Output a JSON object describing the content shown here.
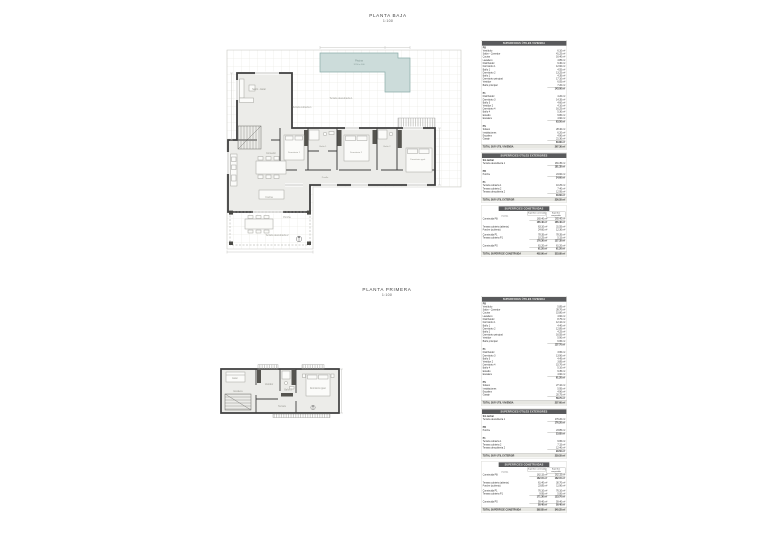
{
  "floors": [
    {
      "title": "PLANTA BAJA",
      "scale": "1:100",
      "labels": {
        "pool": "Piscina",
        "pool_dim": "12.50 x 4.00",
        "terraza1": "Terraza descubierta 1",
        "terraza_cub": "Terraza cubierta 1",
        "salon": "Salón - Estar",
        "comedor": "Comedor",
        "cocina": "Cocina",
        "dorm1": "Dormitorio 1",
        "bano1": "Baño 1",
        "dorm2": "Dormitorio 2",
        "bano2": "Baño 2",
        "dormp": "Dormitorio ppal.",
        "pasillo": "Pasillo",
        "porche": "Porche",
        "terraza2": "Terraza descubierta 2"
      }
    },
    {
      "title": "PLANTA PRIMERA",
      "scale": "1:100",
      "labels": {
        "estar": "Estar",
        "escalera": "Escalera",
        "vestidor": "Vestidor",
        "bano3": "Baño 3",
        "dormp": "Dormitorio ppal.",
        "terraza": "Terraza"
      }
    }
  ],
  "table_groups": [
    {
      "tables": [
        {
          "header": "SUPERFICIES ÚTILES VIVIENDA",
          "rows": [
            {
              "t": "sec",
              "l": "PB"
            },
            {
              "t": "item",
              "l": "Vestíbulo",
              "v": "6.10 m²"
            },
            {
              "t": "item",
              "l": "Salón - Comedor",
              "v": "41.25 m²"
            },
            {
              "t": "item",
              "l": "Cocina",
              "v": "16.40 m²"
            },
            {
              "t": "item",
              "l": "Lavadero",
              "v": "4.85 m²"
            },
            {
              "t": "item",
              "l": "Distribuidor",
              "v": "9.30 m²"
            },
            {
              "t": "item",
              "l": "Dormitorio 1",
              "v": "12.60 m²"
            },
            {
              "t": "item",
              "l": "Baño 1",
              "v": "4.55 m²"
            },
            {
              "t": "item",
              "l": "Dormitorio 2",
              "v": "13.25 m²"
            },
            {
              "t": "item",
              "l": "Baño 2",
              "v": "4.35 m²"
            },
            {
              "t": "item",
              "l": "Dormitorio principal",
              "v": "17.10 m²"
            },
            {
              "t": "item",
              "l": "Vestidor",
              "v": "6.05 m²"
            },
            {
              "t": "item",
              "l": "Baño principal",
              "v": "7.20 m²"
            },
            {
              "t": "sub",
              "v": "143.00 m²"
            },
            {
              "t": "gap"
            },
            {
              "t": "sec",
              "l": "P1"
            },
            {
              "t": "item",
              "l": "Distribuidor",
              "v": "4.20 m²"
            },
            {
              "t": "item",
              "l": "Dormitorio 3",
              "v": "14.35 m²"
            },
            {
              "t": "item",
              "l": "Baño 3",
              "v": "4.60 m²"
            },
            {
              "t": "item",
              "l": "Vestidor 2",
              "v": "4.10 m²"
            },
            {
              "t": "item",
              "l": "Dormitorio 4",
              "v": "16.25 m²"
            },
            {
              "t": "item",
              "l": "Baño 4",
              "v": "5.30 m²"
            },
            {
              "t": "item",
              "l": "Estudio",
              "v": "9.80 m²"
            },
            {
              "t": "item",
              "l": "Escalera",
              "v": "4.90 m²"
            },
            {
              "t": "sub",
              "v": "63.50 m²"
            },
            {
              "t": "gap"
            },
            {
              "t": "sec",
              "l": "PS"
            },
            {
              "t": "item",
              "l": "Sótano",
              "v": "28.40 m²"
            },
            {
              "t": "item",
              "l": "Instalaciones",
              "v": "6.20 m²"
            },
            {
              "t": "item",
              "l": "Escalera",
              "v": "4.90 m²"
            },
            {
              "t": "item",
              "l": "Garaje",
              "v": "21.30 m²"
            },
            {
              "t": "sub",
              "v": "60.80 m²"
            },
            {
              "t": "tot",
              "l": "TOTAL SUP. ÚTIL VIVIENDA",
              "v": "267.30 m²"
            }
          ]
        },
        {
          "header": "SUPERFICIES ÚTILES EXTERIORES",
          "rows": [
            {
              "t": "sec",
              "l": "Sin techar"
            },
            {
              "t": "item",
              "l": "Terraza descubierta 1",
              "v": "181.35 m²"
            },
            {
              "t": "sub",
              "v": "181.35 m²"
            },
            {
              "t": "gap"
            },
            {
              "t": "sec",
              "l": "PB"
            },
            {
              "t": "item",
              "l": "Porche",
              "v": "24.60 m²"
            },
            {
              "t": "sub",
              "v": "24.60 m²"
            },
            {
              "t": "gap"
            },
            {
              "t": "sec",
              "l": "P1"
            },
            {
              "t": "item",
              "l": "Terraza cubierta 1",
              "v": "10.25 m²"
            },
            {
              "t": "item",
              "l": "Terraza cubierta 2",
              "v": "7.40 m²"
            },
            {
              "t": "item",
              "l": "Terraza descubierta 2",
              "v": "12.95 m²"
            },
            {
              "t": "sub",
              "v": "30.60 m²"
            },
            {
              "t": "tot",
              "l": "TOTAL SUP. ÚTIL EXTERIOR",
              "v": "236.55 m²"
            }
          ]
        },
        {
          "header": "SUPERFICIES CONSTRUIDAS",
          "rows": [
            {
              "t": "head3",
              "l": "Vivienda",
              "v": "Superficie construida",
              "v2": "Superficie computable"
            },
            {
              "t": "item3",
              "l": "Construida PB",
              "v": "165.40 m²",
              "v2": "165.40 m²"
            },
            {
              "t": "sub3",
              "v": "165.40 m²",
              "v2": "165.40 m²"
            },
            {
              "t": "gap"
            },
            {
              "t": "item3",
              "l": "Terraza cubierta (abierta)",
              "v": "63.10 m²",
              "v2": "31.55 m²"
            },
            {
              "t": "item3",
              "l": "Porche (cubierto)",
              "v": "24.60 m²",
              "v2": "12.30 m²"
            },
            {
              "t": "gap"
            },
            {
              "t": "item3",
              "l": "Construida P1",
              "v": "78.35 m²",
              "v2": "78.35 m²"
            },
            {
              "t": "item3",
              "l": "Terraza cubierta P1",
              "v": "10.25 m²",
              "v2": "5.15 m²"
            },
            {
              "t": "sub3",
              "v": "176.30 m²",
              "v2": "127.35 m²"
            },
            {
              "t": "gap"
            },
            {
              "t": "item3",
              "l": "Construida PS",
              "v": "61.20 m²",
              "v2": "61.20 m²"
            },
            {
              "t": "sub3",
              "v": "61.20 m²",
              "v2": "61.20 m²"
            },
            {
              "t": "tot3",
              "l": "TOTAL SUPERFICIE CONSTRUIDA",
              "v": "402.90 m²",
              "v2": "353.95 m²"
            }
          ]
        }
      ]
    },
    {
      "tables": [
        {
          "header": "SUPERFICIES ÚTILES VIVIENDA",
          "rows": [
            {
              "t": "sec",
              "l": "PB"
            },
            {
              "t": "item",
              "l": "Vestíbulo",
              "v": "5.85 m²"
            },
            {
              "t": "item",
              "l": "Salón - Comedor",
              "v": "39.70 m²"
            },
            {
              "t": "item",
              "l": "Cocina",
              "v": "15.80 m²"
            },
            {
              "t": "item",
              "l": "Lavadero",
              "v": "4.60 m²"
            },
            {
              "t": "item",
              "l": "Distribuidor",
              "v": "8.75 m²"
            },
            {
              "t": "item",
              "l": "Dormitorio 1",
              "v": "12.10 m²"
            },
            {
              "t": "item",
              "l": "Baño 1",
              "v": "4.40 m²"
            },
            {
              "t": "item",
              "l": "Dormitorio 2",
              "v": "12.85 m²"
            },
            {
              "t": "item",
              "l": "Baño 2",
              "v": "4.25 m²"
            },
            {
              "t": "item",
              "l": "Dormitorio principal",
              "v": "16.55 m²"
            },
            {
              "t": "item",
              "l": "Vestidor",
              "v": "5.90 m²"
            },
            {
              "t": "item",
              "l": "Baño principal",
              "v": "6.95 m²"
            },
            {
              "t": "sub",
              "v": "137.70 m²"
            },
            {
              "t": "gap"
            },
            {
              "t": "sec",
              "l": "P1"
            },
            {
              "t": "item",
              "l": "Distribuidor",
              "v": "3.95 m²"
            },
            {
              "t": "item",
              "l": "Dormitorio 3",
              "v": "13.90 m²"
            },
            {
              "t": "item",
              "l": "Baño 3",
              "v": "4.45 m²"
            },
            {
              "t": "item",
              "l": "Vestidor 2",
              "v": "3.85 m²"
            },
            {
              "t": "item",
              "l": "Dormitorio 4",
              "v": "15.70 m²"
            },
            {
              "t": "item",
              "l": "Baño 4",
              "v": "5.10 m²"
            },
            {
              "t": "item",
              "l": "Estudio",
              "v": "9.35 m²"
            },
            {
              "t": "item",
              "l": "Escalera",
              "v": "4.90 m²"
            },
            {
              "t": "sub",
              "v": "61.20 m²"
            },
            {
              "t": "gap"
            },
            {
              "t": "sec",
              "l": "PS"
            },
            {
              "t": "item",
              "l": "Sótano",
              "v": "27.10 m²"
            },
            {
              "t": "item",
              "l": "Instalaciones",
              "v": "5.95 m²"
            },
            {
              "t": "item",
              "l": "Escalera",
              "v": "4.90 m²"
            },
            {
              "t": "item",
              "l": "Garaje",
              "v": "20.75 m²"
            },
            {
              "t": "sub",
              "v": "58.70 m²"
            },
            {
              "t": "tot",
              "l": "TOTAL SUP. ÚTIL VIVIENDA",
              "v": "257.60 m²"
            }
          ]
        },
        {
          "header": "SUPERFICIES ÚTILES EXTERIORES",
          "rows": [
            {
              "t": "sec",
              "l": "Sin techar"
            },
            {
              "t": "item",
              "l": "Terraza descubierta 1",
              "v": "176.20 m²"
            },
            {
              "t": "sub",
              "v": "176.20 m²"
            },
            {
              "t": "gap"
            },
            {
              "t": "sec",
              "l": "PB"
            },
            {
              "t": "item",
              "l": "Porche",
              "v": "23.85 m²"
            },
            {
              "t": "sub",
              "v": "23.85 m²"
            },
            {
              "t": "gap"
            },
            {
              "t": "sec",
              "l": "P1"
            },
            {
              "t": "item",
              "l": "Terraza cubierta 1",
              "v": "9.95 m²"
            },
            {
              "t": "item",
              "l": "Terraza cubierta 2",
              "v": "7.15 m²"
            },
            {
              "t": "item",
              "l": "Terraza descubierta 2",
              "v": "12.40 m²"
            },
            {
              "t": "sub",
              "v": "29.50 m²"
            },
            {
              "t": "tot",
              "l": "TOTAL SUP. ÚTIL EXTERIOR",
              "v": "229.55 m²"
            }
          ]
        },
        {
          "header": "SUPERFICIES CONSTRUIDAS",
          "rows": [
            {
              "t": "head3",
              "l": "Vivienda",
              "v": "Superficie construida",
              "v2": "Superficie computable"
            },
            {
              "t": "item3",
              "l": "Construida PB",
              "v": "162.15 m²",
              "v2": "162.15 m²"
            },
            {
              "t": "sub3",
              "v": "162.15 m²",
              "v2": "162.15 m²"
            },
            {
              "t": "gap"
            },
            {
              "t": "item3",
              "l": "Terraza cubierta (abierta)",
              "v": "61.40 m²",
              "v2": "30.70 m²"
            },
            {
              "t": "item3",
              "l": "Porche (cubierto)",
              "v": "23.85 m²",
              "v2": "11.90 m²"
            },
            {
              "t": "gap"
            },
            {
              "t": "item3",
              "l": "Construida P1",
              "v": "76.10 m²",
              "v2": "76.10 m²"
            },
            {
              "t": "item3",
              "l": "Terraza cubierta P1",
              "v": "9.95 m²",
              "v2": "5.00 m²"
            },
            {
              "t": "sub3",
              "v": "171.30 m²",
              "v2": "123.70 m²"
            },
            {
              "t": "gap"
            },
            {
              "t": "item3",
              "l": "Construida PS",
              "v": "59.40 m²",
              "v2": "59.40 m²"
            },
            {
              "t": "sub3",
              "v": "59.40 m²",
              "v2": "59.40 m²"
            },
            {
              "t": "tot3",
              "l": "TOTAL SUPERFICIE CONSTRUIDA",
              "v": "392.85 m²",
              "v2": "345.25 m²"
            }
          ]
        }
      ]
    }
  ]
}
